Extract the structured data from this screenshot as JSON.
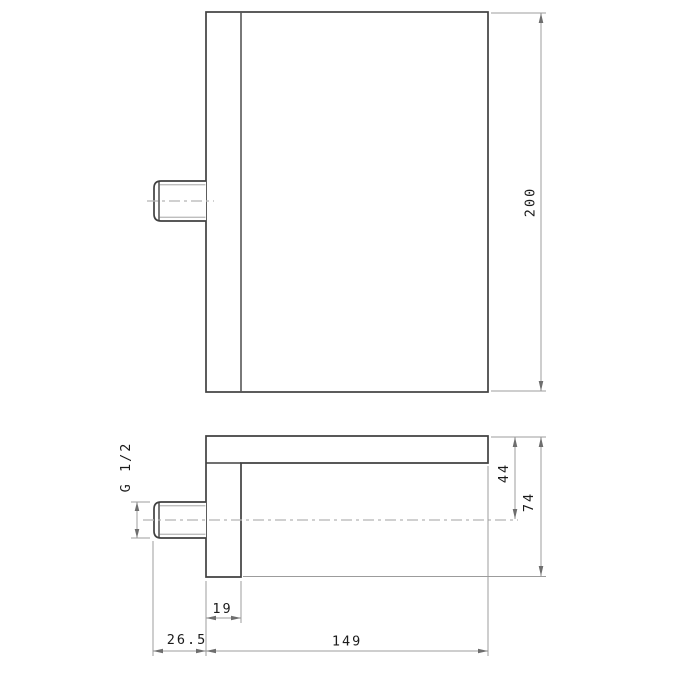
{
  "colors": {
    "background": "#ffffff",
    "outline": "#404040",
    "dim_line": "#9c9c9c",
    "centerline": "#b5b5b5",
    "thread_line": "#979797",
    "arrow": "#6e6e6e",
    "label": "#1b1b1b"
  },
  "dimensions": {
    "overall_height_label": "200",
    "thread_label": "G 1/2",
    "center_depth_label": "44",
    "overall_depth_label": "74",
    "leg_width_label": "19",
    "stub_length_label": "26.5",
    "body_length_label": "149"
  }
}
